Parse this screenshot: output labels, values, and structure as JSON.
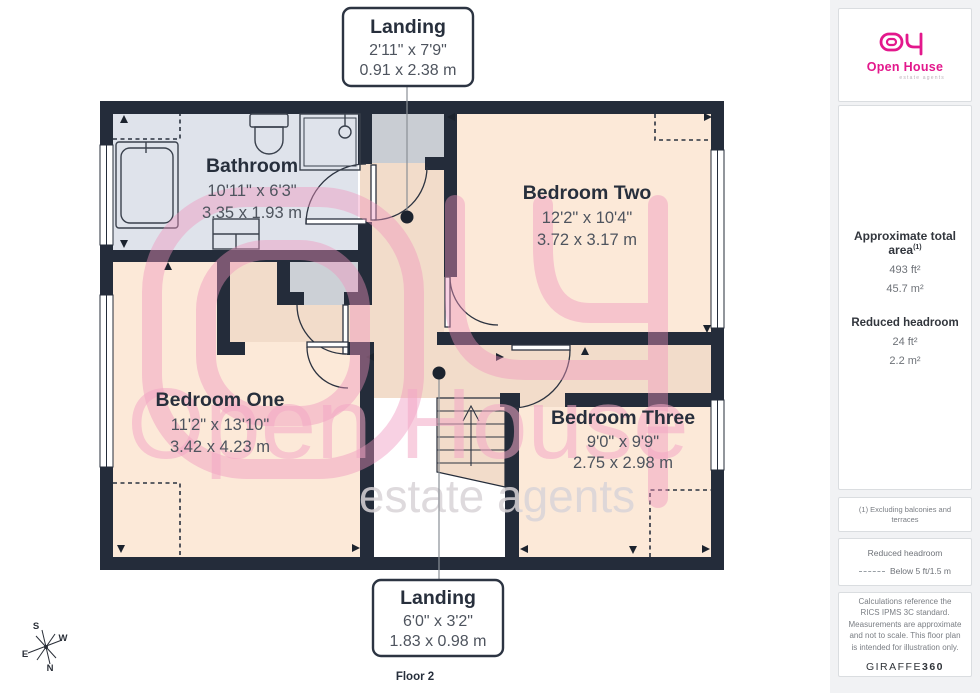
{
  "plan": {
    "rooms": {
      "bathroom": {
        "name": "Bathroom",
        "imperial": "10'11\" x 6'3\"",
        "metric": "3.35 x 1.93 m"
      },
      "bedroom_two": {
        "name": "Bedroom Two",
        "imperial": "12'2\" x 10'4\"",
        "metric": "3.72 x 3.17 m"
      },
      "bedroom_one": {
        "name": "Bedroom One",
        "imperial": "11'2\" x 13'10\"",
        "metric": "3.42 x 4.23 m"
      },
      "bedroom_three": {
        "name": "Bedroom Three",
        "imperial": "9'0\" x 9'9\"",
        "metric": "2.75 x 2.98 m"
      }
    },
    "callouts": {
      "top": {
        "name": "Landing",
        "imperial": "2'11\" x 7'9\"",
        "metric": "0.91 x 2.38 m"
      },
      "bottom": {
        "name": "Landing",
        "imperial": "6'0\" x 3'2\"",
        "metric": "1.83 x 0.98 m"
      }
    },
    "floor_label": "Floor 2",
    "compass": {
      "north": "N",
      "south": "S",
      "east": "E",
      "west": "W"
    },
    "watermark": {
      "brand": "Open House",
      "tagline": "estate agents"
    }
  },
  "sidebar": {
    "logo": {
      "brand": "Open House",
      "tagline": "estate agents"
    },
    "area_summary": {
      "title": "Approximate total area",
      "footnote_marker": "(1)",
      "area_ft": "493 ft²",
      "area_m": "45.7 m²",
      "headroom_title": "Reduced headroom",
      "headroom_ft": "24 ft²",
      "headroom_m": "2.2 m²"
    },
    "footnote": "(1) Excluding balconies and terraces",
    "legend": {
      "title": "Reduced headroom",
      "item": "Below 5 ft/1.5 m"
    },
    "disclaimer": "Calculations reference the RICS IPMS 3C standard. Measurements are approximate and not to scale. This floor plan is intended for illustration only.",
    "brand_footer": {
      "name": "GIRAFFE",
      "suffix": "360"
    }
  },
  "colors": {
    "wall": "#242c3a",
    "floor_peach": "#fce9d8",
    "floor_tan": "#f2dcca",
    "floor_gray": "#dfe3eb",
    "closet_gray": "#ccd0d6",
    "brand_pink": "#e3188c",
    "watermark_pink": "#f3a8c6"
  }
}
